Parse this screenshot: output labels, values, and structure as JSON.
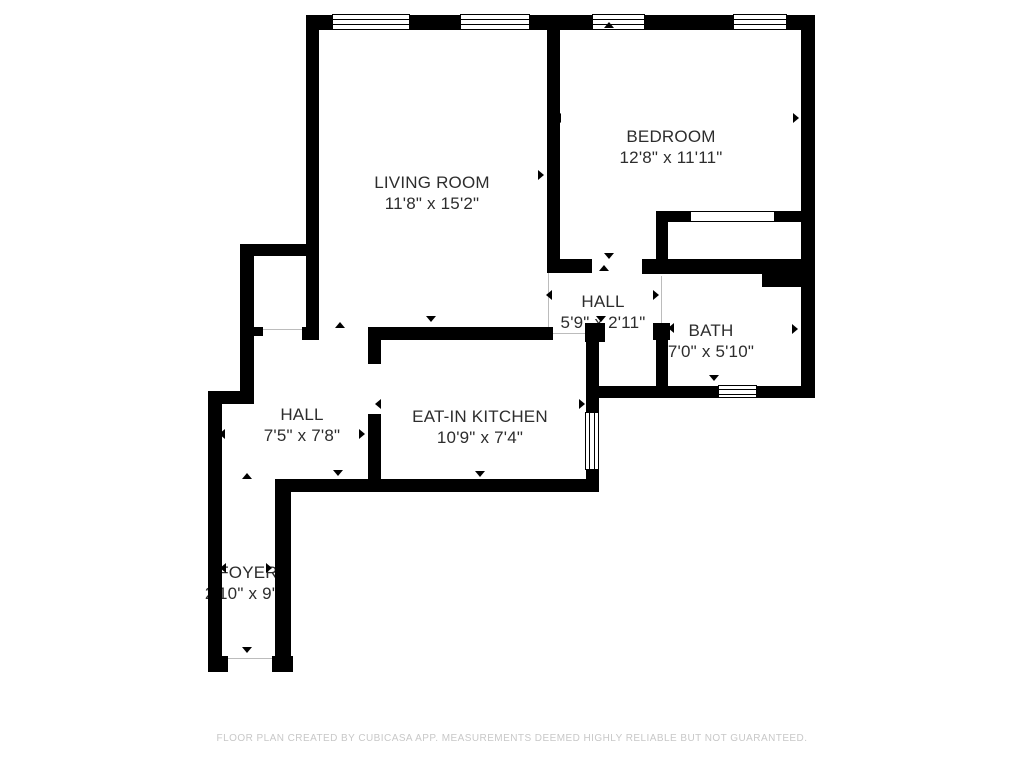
{
  "footer": {
    "disclaimer": "FLOOR PLAN CREATED BY CUBICASA APP. MEASUREMENTS DEEMED HIGHLY RELIABLE BUT NOT GUARANTEED."
  },
  "colors": {
    "wall": "#000000",
    "label_text": "#2d2d2d",
    "footer_text": "#c8c8c8",
    "opening_line": "#bcbcbc",
    "background": "#ffffff"
  },
  "rooms": [
    {
      "id": "living-room",
      "label": "LIVING ROOM",
      "dims": "11'8\" x 15'2\"",
      "cx": 432,
      "cy": 193
    },
    {
      "id": "bedroom",
      "label": "BEDROOM",
      "dims": "12'8\" x 11'11\"",
      "cx": 671,
      "cy": 147
    },
    {
      "id": "hall-upper",
      "label": "HALL",
      "dims": "5'9\" x 2'11\"",
      "cx": 603,
      "cy": 312
    },
    {
      "id": "bath",
      "label": "BATH",
      "dims": "7'0\" x 5'10\"",
      "cx": 711,
      "cy": 341
    },
    {
      "id": "hall-lower",
      "label": "HALL",
      "dims": "7'5\" x 7'8\"",
      "cx": 302,
      "cy": 425
    },
    {
      "id": "eat-in-kitchen",
      "label": "EAT-IN KITCHEN",
      "dims": "10'9\" x 7'4\"",
      "cx": 480,
      "cy": 427
    },
    {
      "id": "foyer",
      "label": "FOYER",
      "dims": "2'10\" x 9'1\"",
      "cx": 248,
      "cy": 583
    }
  ],
  "plan": {
    "walls": [
      {
        "id": "top",
        "x": 306,
        "y": 15,
        "w": 509,
        "h": 15
      },
      {
        "id": "living-left",
        "x": 306,
        "y": 15,
        "w": 13,
        "h": 325
      },
      {
        "id": "living-bed-divider",
        "x": 547,
        "y": 15,
        "w": 13,
        "h": 250
      },
      {
        "id": "living-bottom-right",
        "x": 547,
        "y": 259,
        "w": 45,
        "h": 14
      },
      {
        "id": "right",
        "x": 801,
        "y": 15,
        "w": 14,
        "h": 383
      },
      {
        "id": "bedroom-bottom",
        "x": 642,
        "y": 259,
        "w": 120,
        "h": 15
      },
      {
        "id": "bedroom-bottom-thick",
        "x": 762,
        "y": 259,
        "w": 53,
        "h": 28
      },
      {
        "id": "closet-left",
        "x": 656,
        "y": 211,
        "w": 12,
        "h": 55
      },
      {
        "id": "closet-top-left",
        "x": 656,
        "y": 211,
        "w": 35,
        "h": 11
      },
      {
        "id": "closet-top-right",
        "x": 775,
        "y": 211,
        "w": 40,
        "h": 11
      },
      {
        "id": "alcove-top",
        "x": 240,
        "y": 244,
        "w": 79,
        "h": 12
      },
      {
        "id": "alcove-left",
        "x": 240,
        "y": 244,
        "w": 14,
        "h": 152
      },
      {
        "id": "alcove-jamb",
        "x": 254,
        "y": 327,
        "w": 9,
        "h": 9
      },
      {
        "id": "living-left-foot",
        "x": 302,
        "y": 327,
        "w": 17,
        "h": 13
      },
      {
        "id": "left-step",
        "x": 208,
        "y": 391,
        "w": 46,
        "h": 13
      },
      {
        "id": "foyer-left",
        "x": 208,
        "y": 391,
        "w": 14,
        "h": 281
      },
      {
        "id": "foyer-foot-left",
        "x": 208,
        "y": 656,
        "w": 20,
        "h": 16
      },
      {
        "id": "foyer-foot-right",
        "x": 272,
        "y": 656,
        "w": 21,
        "h": 16
      },
      {
        "id": "foyer-right",
        "x": 275,
        "y": 487,
        "w": 16,
        "h": 185
      },
      {
        "id": "hall-kitchen-bottom",
        "x": 275,
        "y": 479,
        "w": 323,
        "h": 13
      },
      {
        "id": "kitchen-left-upper",
        "x": 368,
        "y": 327,
        "w": 13,
        "h": 37
      },
      {
        "id": "kitchen-left-lower",
        "x": 368,
        "y": 414,
        "w": 13,
        "h": 78
      },
      {
        "id": "kitchen-top",
        "x": 368,
        "y": 327,
        "w": 185,
        "h": 13
      },
      {
        "id": "kitchen-right-jamb",
        "x": 585,
        "y": 323,
        "w": 20,
        "h": 19
      },
      {
        "id": "kitchen-right-upper",
        "x": 586,
        "y": 342,
        "w": 13,
        "h": 72
      },
      {
        "id": "kitchen-right-lower",
        "x": 586,
        "y": 468,
        "w": 13,
        "h": 24
      },
      {
        "id": "bath-door-jamb",
        "x": 653,
        "y": 323,
        "w": 17,
        "h": 17
      },
      {
        "id": "bath-left",
        "x": 656,
        "y": 340,
        "w": 12,
        "h": 58
      },
      {
        "id": "bath-bottom",
        "x": 586,
        "y": 386,
        "w": 229,
        "h": 12
      }
    ],
    "windows": [
      {
        "id": "living-room-window-1",
        "x": 332,
        "y": 14,
        "w": 78,
        "h": 16,
        "o": "h"
      },
      {
        "id": "living-room-window-2",
        "x": 460,
        "y": 14,
        "w": 70,
        "h": 16,
        "o": "h"
      },
      {
        "id": "bedroom-window-1",
        "x": 592,
        "y": 14,
        "w": 53,
        "h": 16,
        "o": "h"
      },
      {
        "id": "bedroom-window-2",
        "x": 733,
        "y": 14,
        "w": 54,
        "h": 16,
        "o": "h"
      },
      {
        "id": "bath-window",
        "x": 718,
        "y": 385,
        "w": 39,
        "h": 13,
        "o": "h"
      },
      {
        "id": "kitchen-window",
        "x": 585,
        "y": 412,
        "w": 14,
        "h": 58,
        "o": "v"
      },
      {
        "id": "closet-sliding-door",
        "x": 690,
        "y": 211,
        "w": 85,
        "h": 11,
        "o": "slider"
      }
    ],
    "openings": [
      {
        "id": "living-hall-boundary",
        "x": 548,
        "y": 273,
        "len": 55,
        "o": "v"
      },
      {
        "id": "bath-door-opening",
        "x": 661,
        "y": 276,
        "len": 47,
        "o": "v"
      },
      {
        "id": "closet-opening",
        "x": 256,
        "y": 329,
        "len": 48,
        "o": "h"
      },
      {
        "id": "entry-door-opening",
        "x": 228,
        "y": 658,
        "len": 44,
        "o": "h"
      },
      {
        "id": "kitchen-door-opening",
        "x": 553,
        "y": 333,
        "len": 32,
        "o": "h"
      }
    ],
    "arrows": [
      {
        "x": 427,
        "y": 27,
        "d": "up"
      },
      {
        "x": 318,
        "y": 175,
        "d": "left"
      },
      {
        "x": 543,
        "y": 175,
        "d": "right"
      },
      {
        "x": 431,
        "y": 321,
        "d": "down"
      },
      {
        "x": 609,
        "y": 27,
        "d": "up"
      },
      {
        "x": 560,
        "y": 118,
        "d": "left"
      },
      {
        "x": 798,
        "y": 118,
        "d": "right"
      },
      {
        "x": 609,
        "y": 258,
        "d": "down"
      },
      {
        "x": 604,
        "y": 270,
        "d": "up"
      },
      {
        "x": 551,
        "y": 295,
        "d": "left"
      },
      {
        "x": 658,
        "y": 295,
        "d": "right"
      },
      {
        "x": 601,
        "y": 321,
        "d": "down"
      },
      {
        "x": 711,
        "y": 268,
        "d": "up"
      },
      {
        "x": 673,
        "y": 328,
        "d": "left"
      },
      {
        "x": 797,
        "y": 329,
        "d": "right"
      },
      {
        "x": 714,
        "y": 380,
        "d": "down"
      },
      {
        "x": 340,
        "y": 327,
        "d": "up"
      },
      {
        "x": 224,
        "y": 434,
        "d": "left"
      },
      {
        "x": 364,
        "y": 434,
        "d": "right"
      },
      {
        "x": 338,
        "y": 475,
        "d": "down"
      },
      {
        "x": 477,
        "y": 332,
        "d": "up"
      },
      {
        "x": 380,
        "y": 404,
        "d": "left"
      },
      {
        "x": 584,
        "y": 404,
        "d": "right"
      },
      {
        "x": 480,
        "y": 476,
        "d": "down"
      },
      {
        "x": 247,
        "y": 478,
        "d": "up"
      },
      {
        "x": 225,
        "y": 568,
        "d": "left"
      },
      {
        "x": 271,
        "y": 568,
        "d": "right"
      },
      {
        "x": 247,
        "y": 652,
        "d": "down"
      }
    ]
  }
}
